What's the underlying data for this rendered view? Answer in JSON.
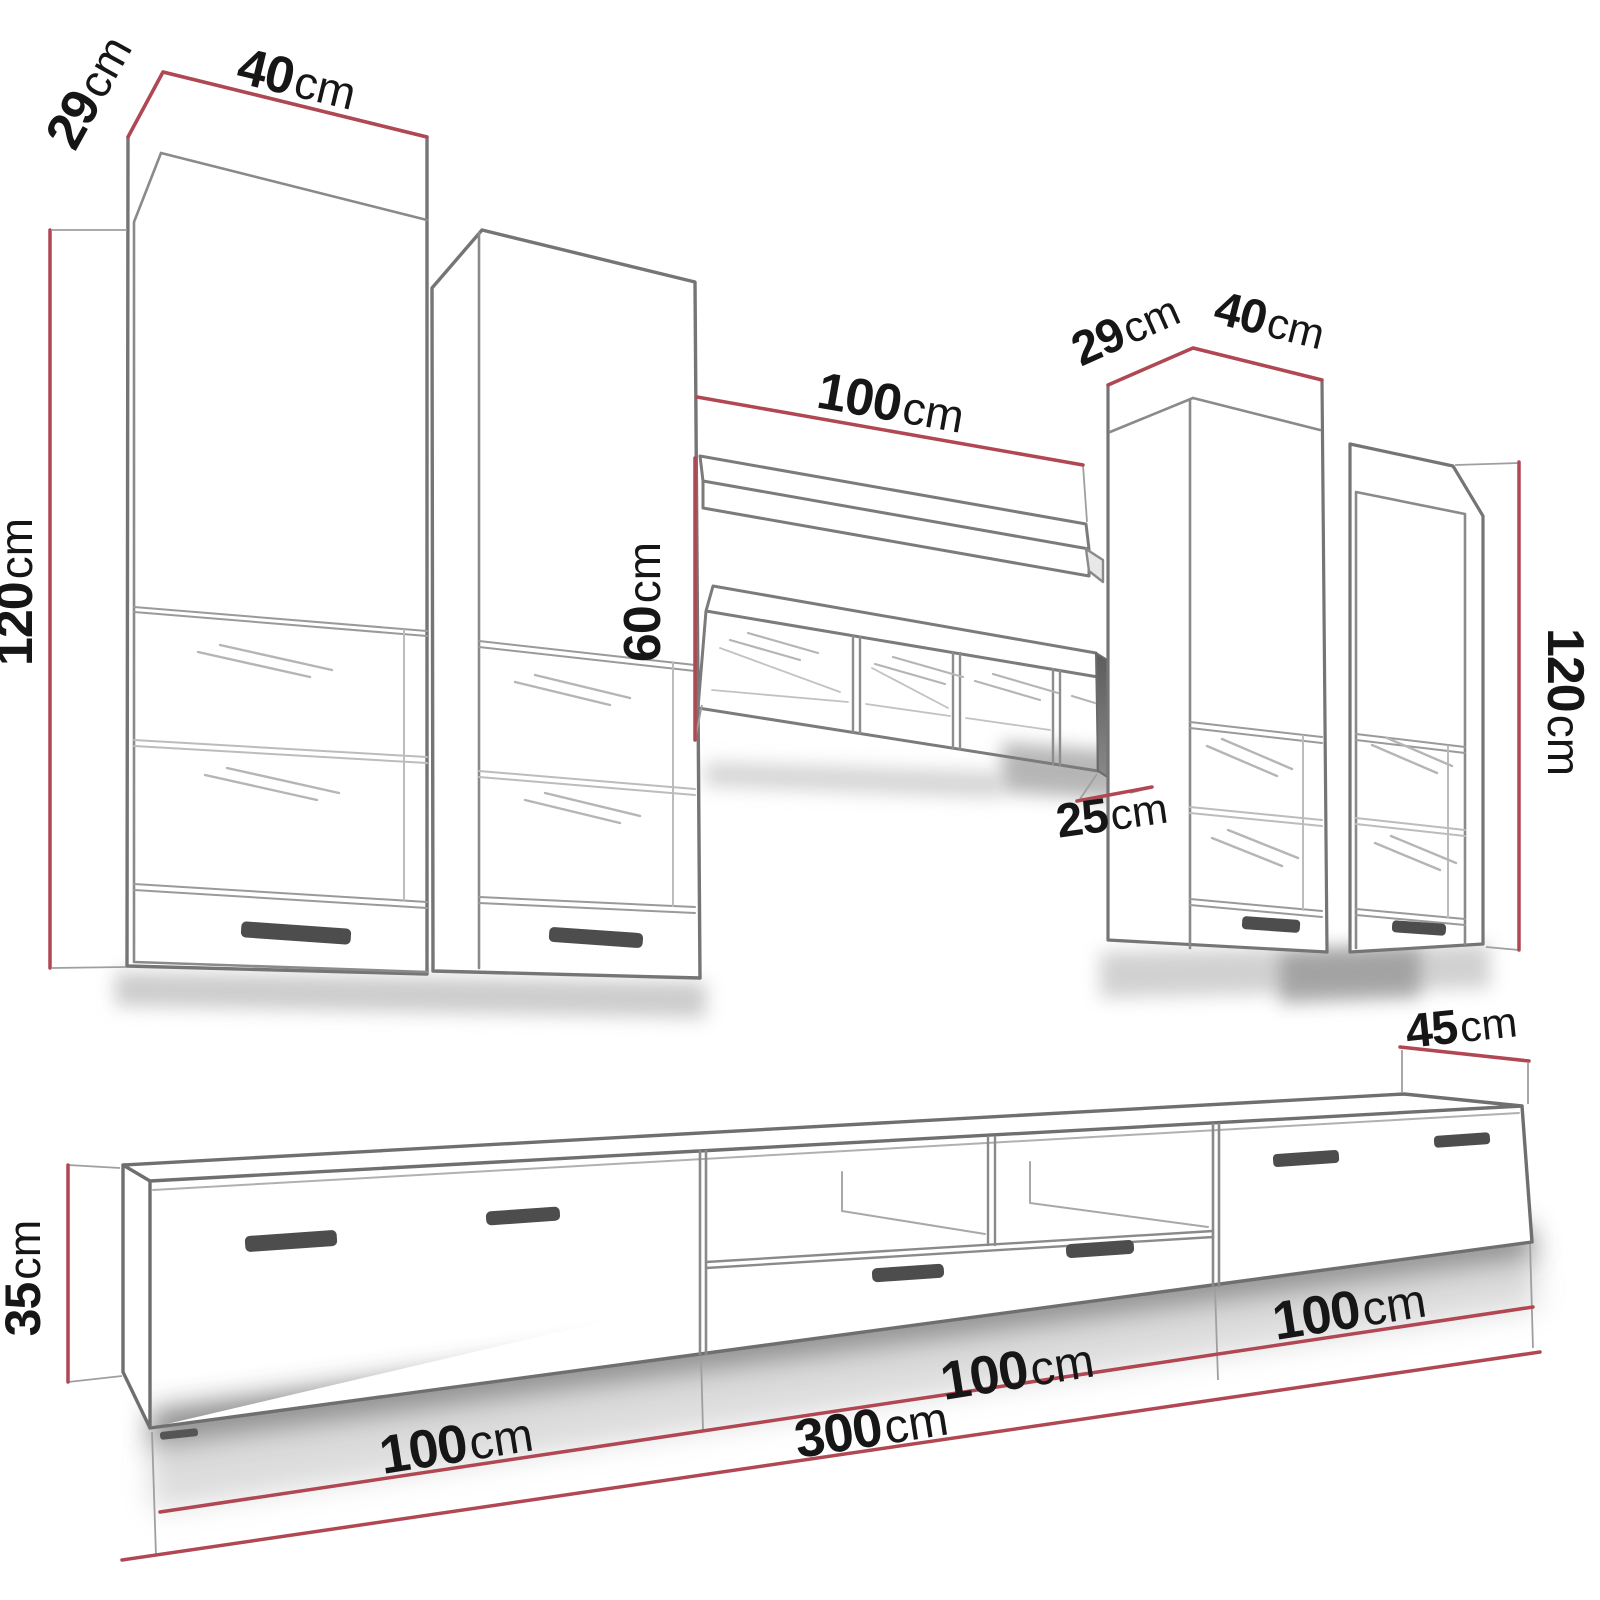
{
  "colors": {
    "dimension_red": "#b04753",
    "outline_gray": "#757575",
    "inner_gray": "#8a8a8a",
    "light_gray": "#b5b5b5",
    "text_black": "#161616",
    "handle_gray": "#4d4d4d",
    "shadow_gray": "#9a9a9a",
    "background": "#ffffff"
  },
  "dims": {
    "left_width": {
      "num": "40",
      "unit": "cm"
    },
    "left_depth": {
      "num": "29",
      "unit": "cm"
    },
    "left_height": {
      "num": "120",
      "unit": "cm"
    },
    "mid_width": {
      "num": "100",
      "unit": "cm"
    },
    "mid_height": {
      "num": "60",
      "unit": "cm"
    },
    "mid_depth": {
      "num": "25",
      "unit": "cm"
    },
    "right_depth": {
      "num": "29",
      "unit": "cm"
    },
    "right_width": {
      "num": "40",
      "unit": "cm"
    },
    "right_height": {
      "num": "120",
      "unit": "cm"
    },
    "tv_depth": {
      "num": "45",
      "unit": "cm"
    },
    "tv_height": {
      "num": "35",
      "unit": "cm"
    },
    "tv_section1": {
      "num": "100",
      "unit": "cm"
    },
    "tv_section2": {
      "num": "100",
      "unit": "cm"
    },
    "tv_section3": {
      "num": "100",
      "unit": "cm"
    },
    "tv_total": {
      "num": "300",
      "unit": "cm"
    }
  }
}
